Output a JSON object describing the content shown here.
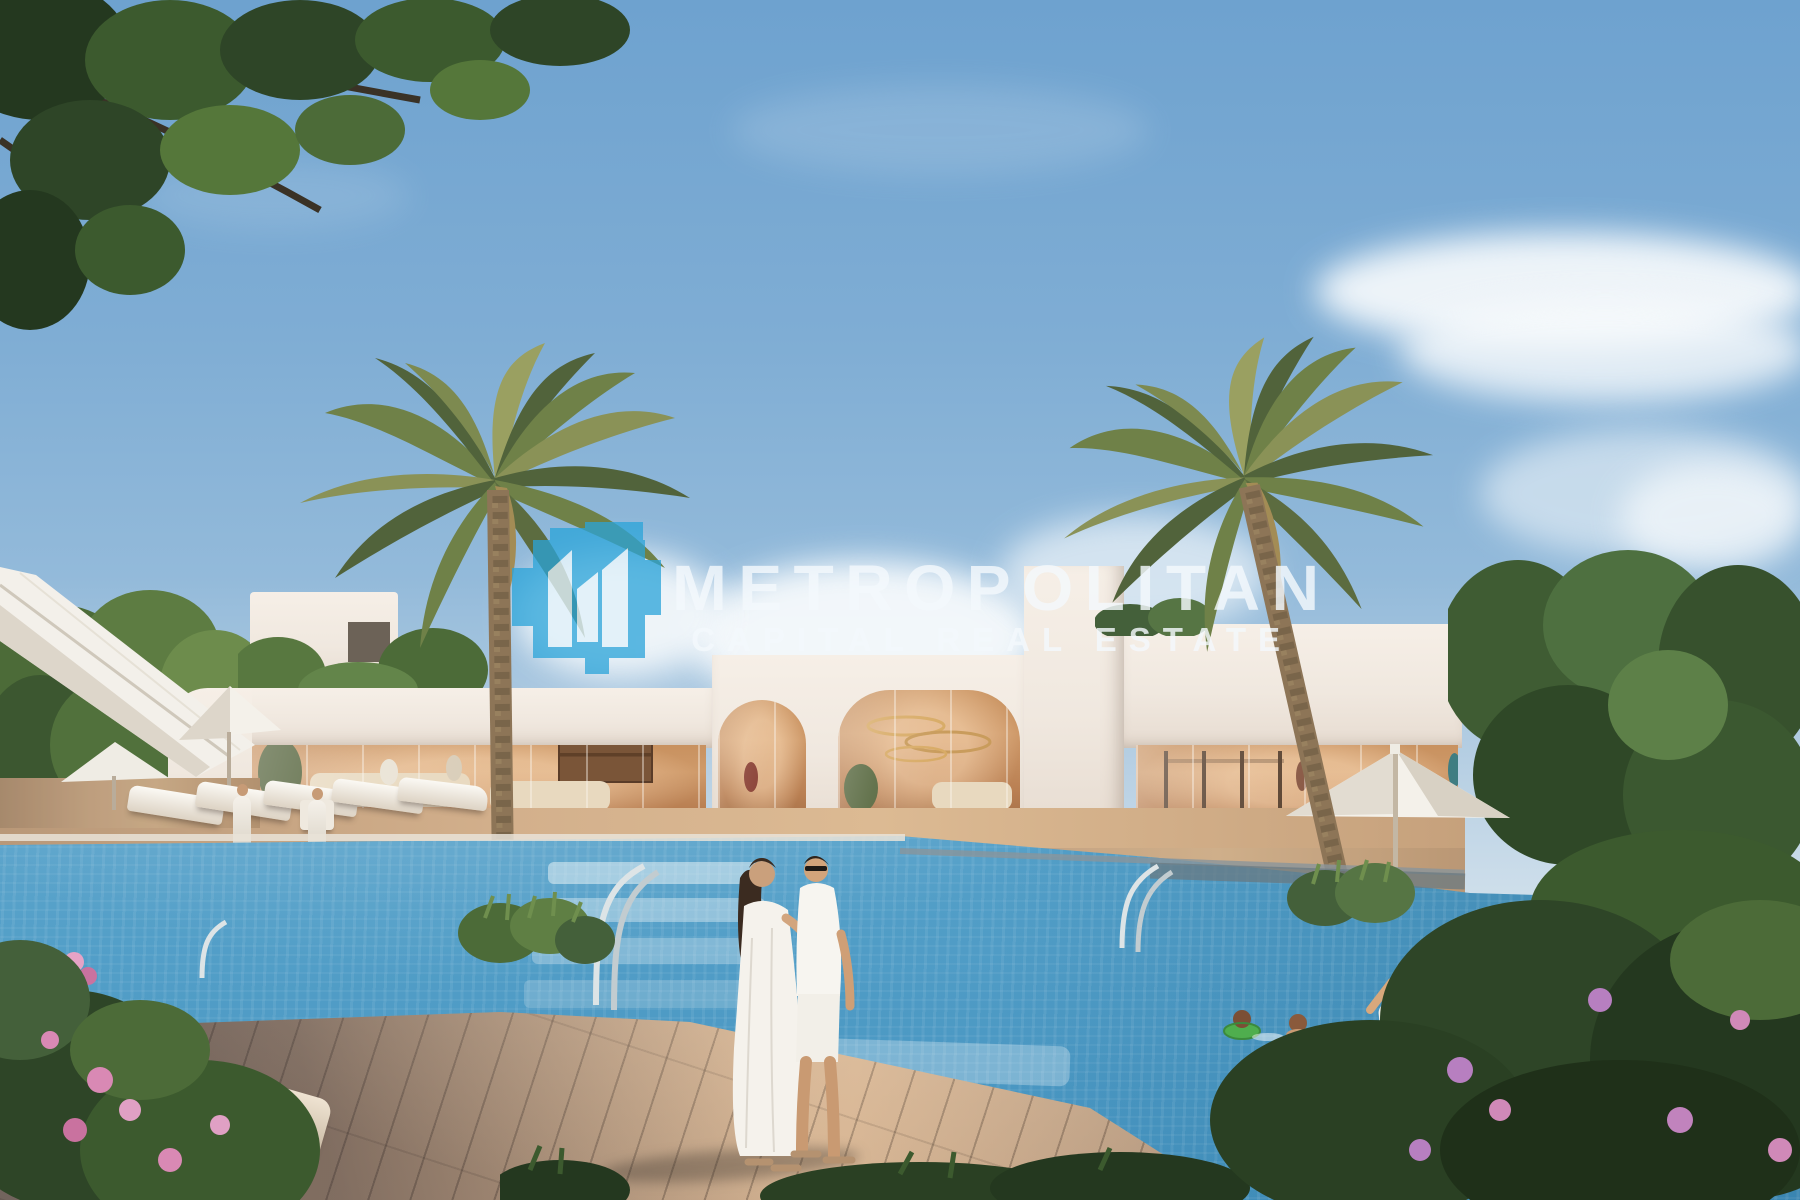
{
  "watermark": {
    "title": "METROPOLITAN",
    "subtitle": "CAPITAL REAL ESTATE",
    "logo_icon": "metropolitan-buildings-icon"
  },
  "colors": {
    "logo-blue": "#2ba4da",
    "watermark-white": "#f4f9fd",
    "sky-top": "#6ea2cf",
    "sky-horizon": "#cfdfeb",
    "cloud-white": "#f7fafc",
    "building-white": "#f0e8df",
    "glass-warm": "#cf9a6a",
    "pool-light": "#a9cddc",
    "pool-mid": "#6fb0d2",
    "pool-deep": "#4391be",
    "deck-tan": "#d6b492",
    "palm-dark": "#51633b",
    "palm-mid": "#6f8148",
    "palm-light": "#9aa061",
    "foliage-dark": "#2e4527",
    "foliage-mid": "#4c6b38",
    "flower-pink": "#d989b4",
    "trunk-brown": "#8d7557",
    "furniture-white": "#f2efe9"
  }
}
